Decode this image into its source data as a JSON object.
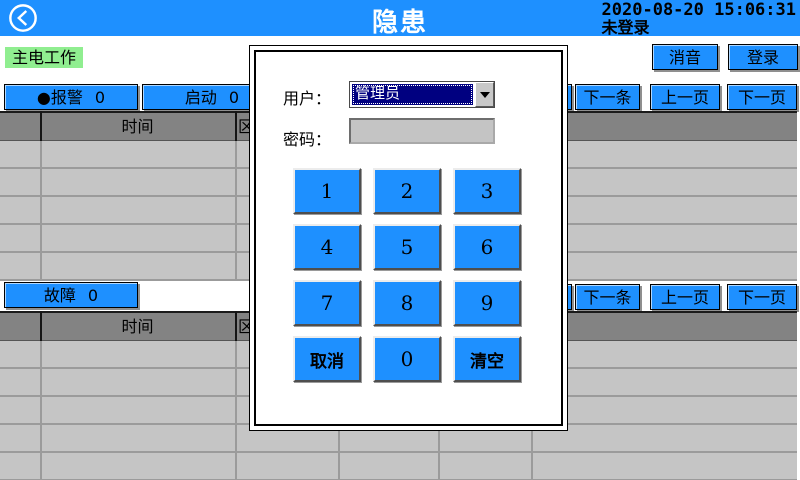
{
  "header": {
    "title": "隐患",
    "datetime": "2020-08-20 15:06:31",
    "login_status": "未登录"
  },
  "status": {
    "main_power": "主电工作"
  },
  "toolbar": {
    "mute": "消音",
    "login": "登录"
  },
  "counters": {
    "alarm_bullet": "●",
    "alarm_label": "报警",
    "alarm_count": "0",
    "start_label": "启动",
    "start_count": "0",
    "fault_label": "故障",
    "fault_count": "0"
  },
  "pager": {
    "next_item": "下一条",
    "prev_page": "上一页",
    "next_page": "下一页"
  },
  "table": {
    "time_col": "时间",
    "zone_col": "区"
  },
  "dialog": {
    "user_label": "用户：",
    "user_value": "管理员",
    "password_label": "密码：",
    "password_value": "",
    "keypad": [
      "1",
      "2",
      "3",
      "4",
      "5",
      "6",
      "7",
      "8",
      "9",
      "取消",
      "0",
      "清空"
    ]
  },
  "colors": {
    "accent_blue": "#1E90FF",
    "table_header_grey": "#838383",
    "table_row_grey": "#C5C5C5",
    "power_green": "#90EE90",
    "selection_navy": "#000080"
  }
}
